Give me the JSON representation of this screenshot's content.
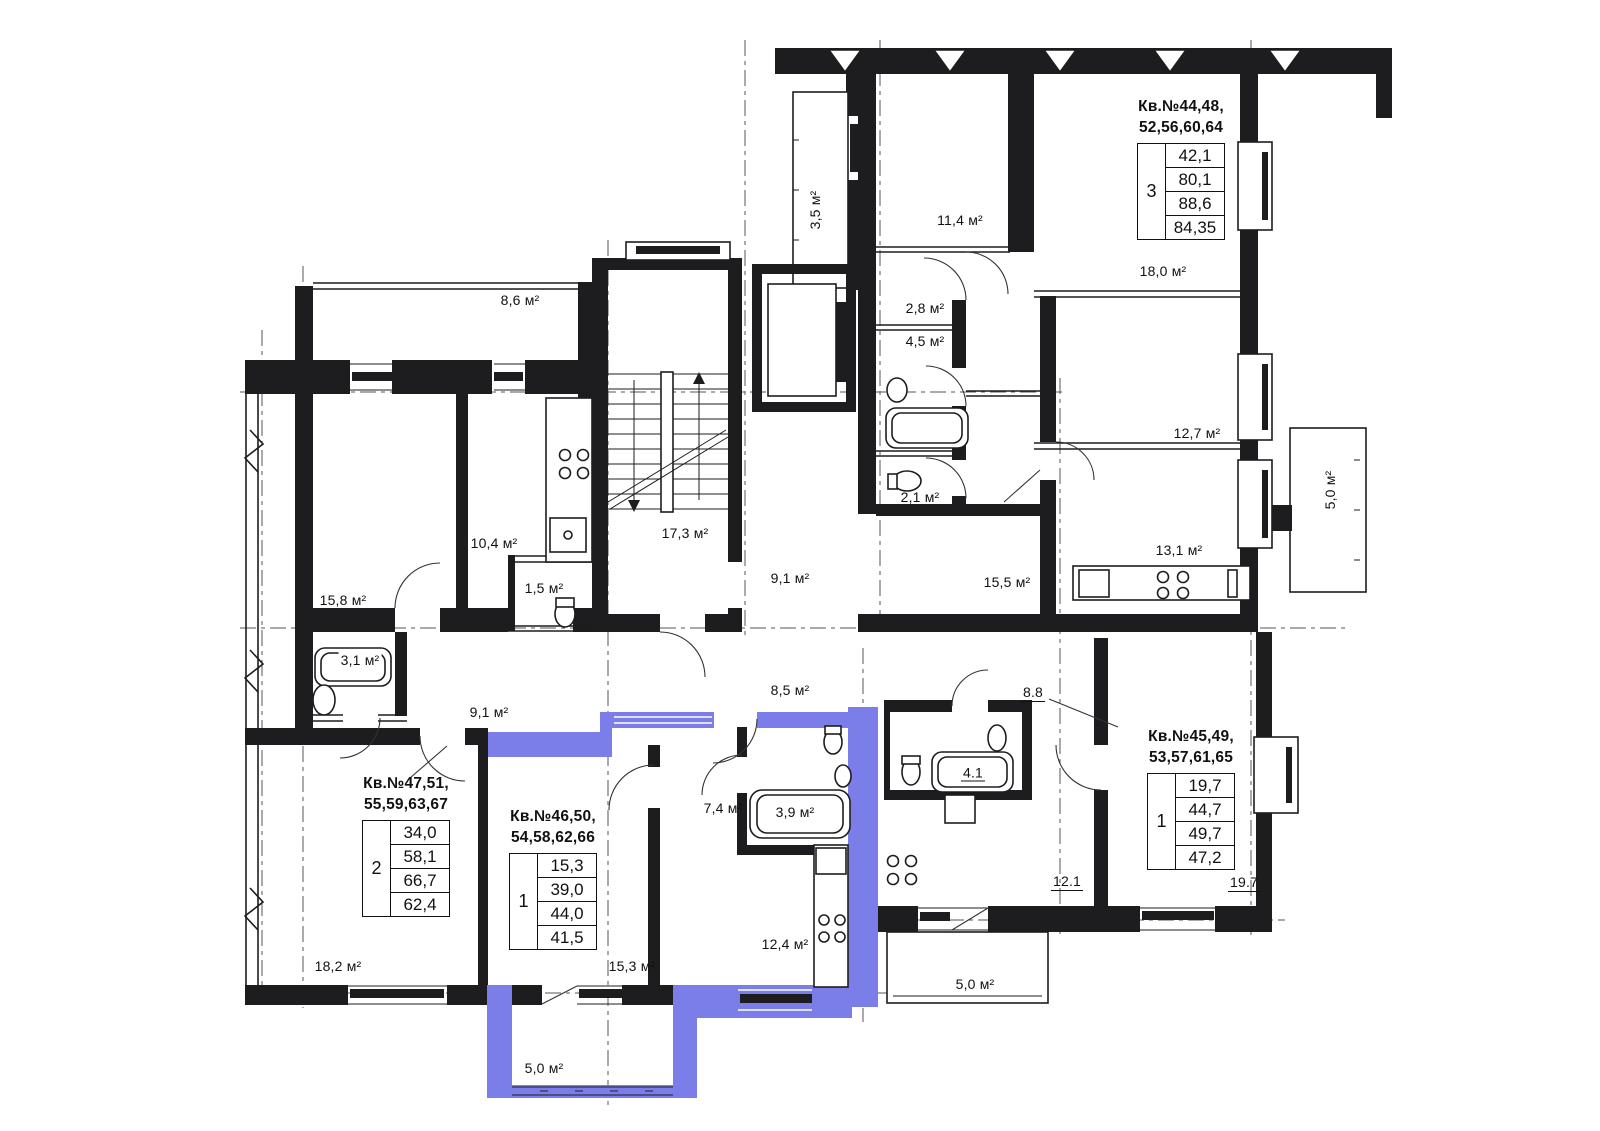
{
  "plan": {
    "highlight_color": "#7b7ee9",
    "wall_color": "#1d1d1f",
    "axis_color": "#555555"
  },
  "apartments": [
    {
      "title_line1": "Кв.№44,48,",
      "title_line2": "52,56,60,64",
      "rooms": "3",
      "areas": [
        "42,1",
        "80,1",
        "88,6",
        "84,35"
      ]
    },
    {
      "title_line1": "Кв.№47,51,",
      "title_line2": "55,59,63,67",
      "rooms": "2",
      "areas": [
        "34,0",
        "58,1",
        "66,7",
        "62,4"
      ]
    },
    {
      "title_line1": "Кв.№46,50,",
      "title_line2": "54,58,62,66",
      "rooms": "1",
      "areas": [
        "15,3",
        "39,0",
        "44,0",
        "41,5"
      ]
    },
    {
      "title_line1": "Кв.№45,49,",
      "title_line2": "53,57,61,65",
      "rooms": "1",
      "areas": [
        "19,7",
        "44,7",
        "49,7",
        "47,2"
      ]
    }
  ],
  "room_labels": [
    {
      "text": "3,5 м²"
    },
    {
      "text": "11,4 м²"
    },
    {
      "text": "8,6 м²"
    },
    {
      "text": "2,8 м²"
    },
    {
      "text": "4,5 м²"
    },
    {
      "text": "18,0 м²"
    },
    {
      "text": "12,7 м²"
    },
    {
      "text": "5,0 м²"
    },
    {
      "text": "10,4 м²"
    },
    {
      "text": "17,3 м²"
    },
    {
      "text": "13,1 м²"
    },
    {
      "text": "2,1 м²"
    },
    {
      "text": "1,5 м²"
    },
    {
      "text": "15,8 м²"
    },
    {
      "text": "9,1 м²"
    },
    {
      "text": "15,5 м²"
    },
    {
      "text": "3,1 м²"
    },
    {
      "text": "9,1 м²"
    },
    {
      "text": "8,5 м²"
    },
    {
      "text": "8.8"
    },
    {
      "text": "7,4 м²"
    },
    {
      "text": "3,9 м²"
    },
    {
      "text": "4.1"
    },
    {
      "text": "12,4 м²"
    },
    {
      "text": "12.1"
    },
    {
      "text": "19.7"
    },
    {
      "text": "18,2 м²"
    },
    {
      "text": "15,3 м²"
    },
    {
      "text": "5,0 м²"
    },
    {
      "text": "5,0 м²"
    }
  ]
}
